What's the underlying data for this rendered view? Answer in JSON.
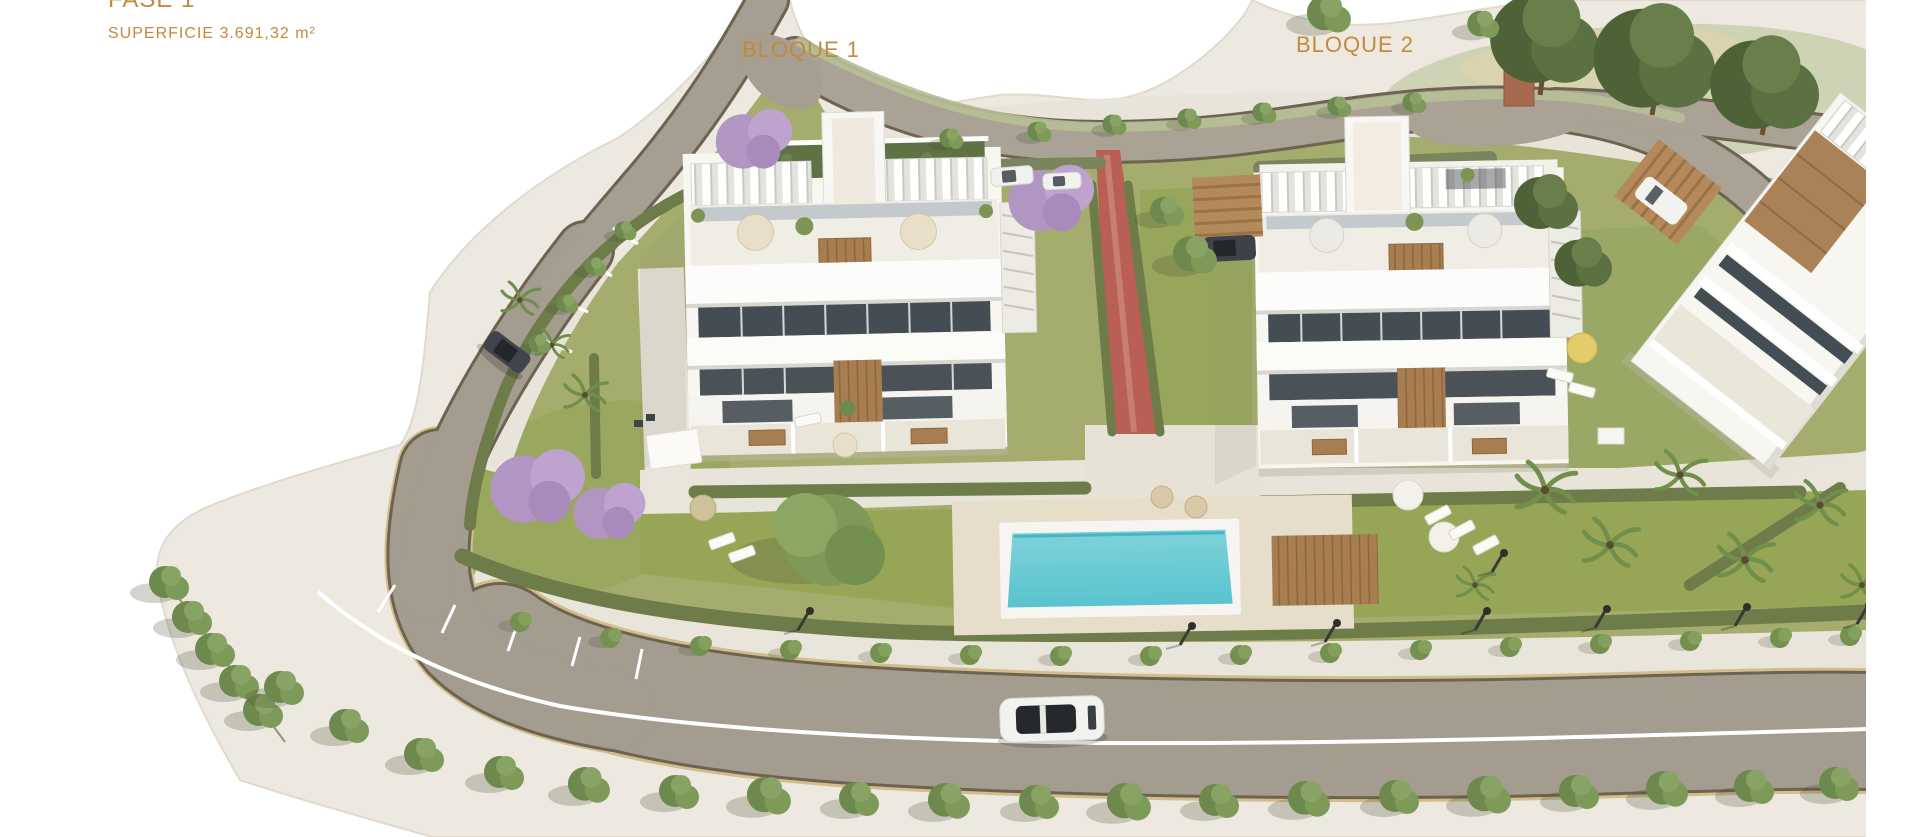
{
  "title": "FASE 1 residential development aerial render",
  "labels": {
    "phase": "FASE 1",
    "area": "SUPERFICIE 3.691,32 m²",
    "block1": "BLOQUE 1",
    "block2": "BLOQUE 2"
  },
  "colors": {
    "label_text": "#c28a3c",
    "ground_margin": "#ede9e1",
    "road": "#a39c8f",
    "road_edge": "#6d6350",
    "road_sand": "#d2bd8c",
    "road_marking": "#ffffff",
    "lawn": "#a5ad6e",
    "lawn_bright": "#97a557",
    "hedge": "#6d7c49",
    "pool_water": "#6ec9d4",
    "pool_deck": "#e6ddca",
    "building_white": "#f7f6f1",
    "wood": "#a87e51",
    "window_dark": "#454d54",
    "red_path": "#b95f55",
    "jacaranda": "#b197c2"
  }
}
